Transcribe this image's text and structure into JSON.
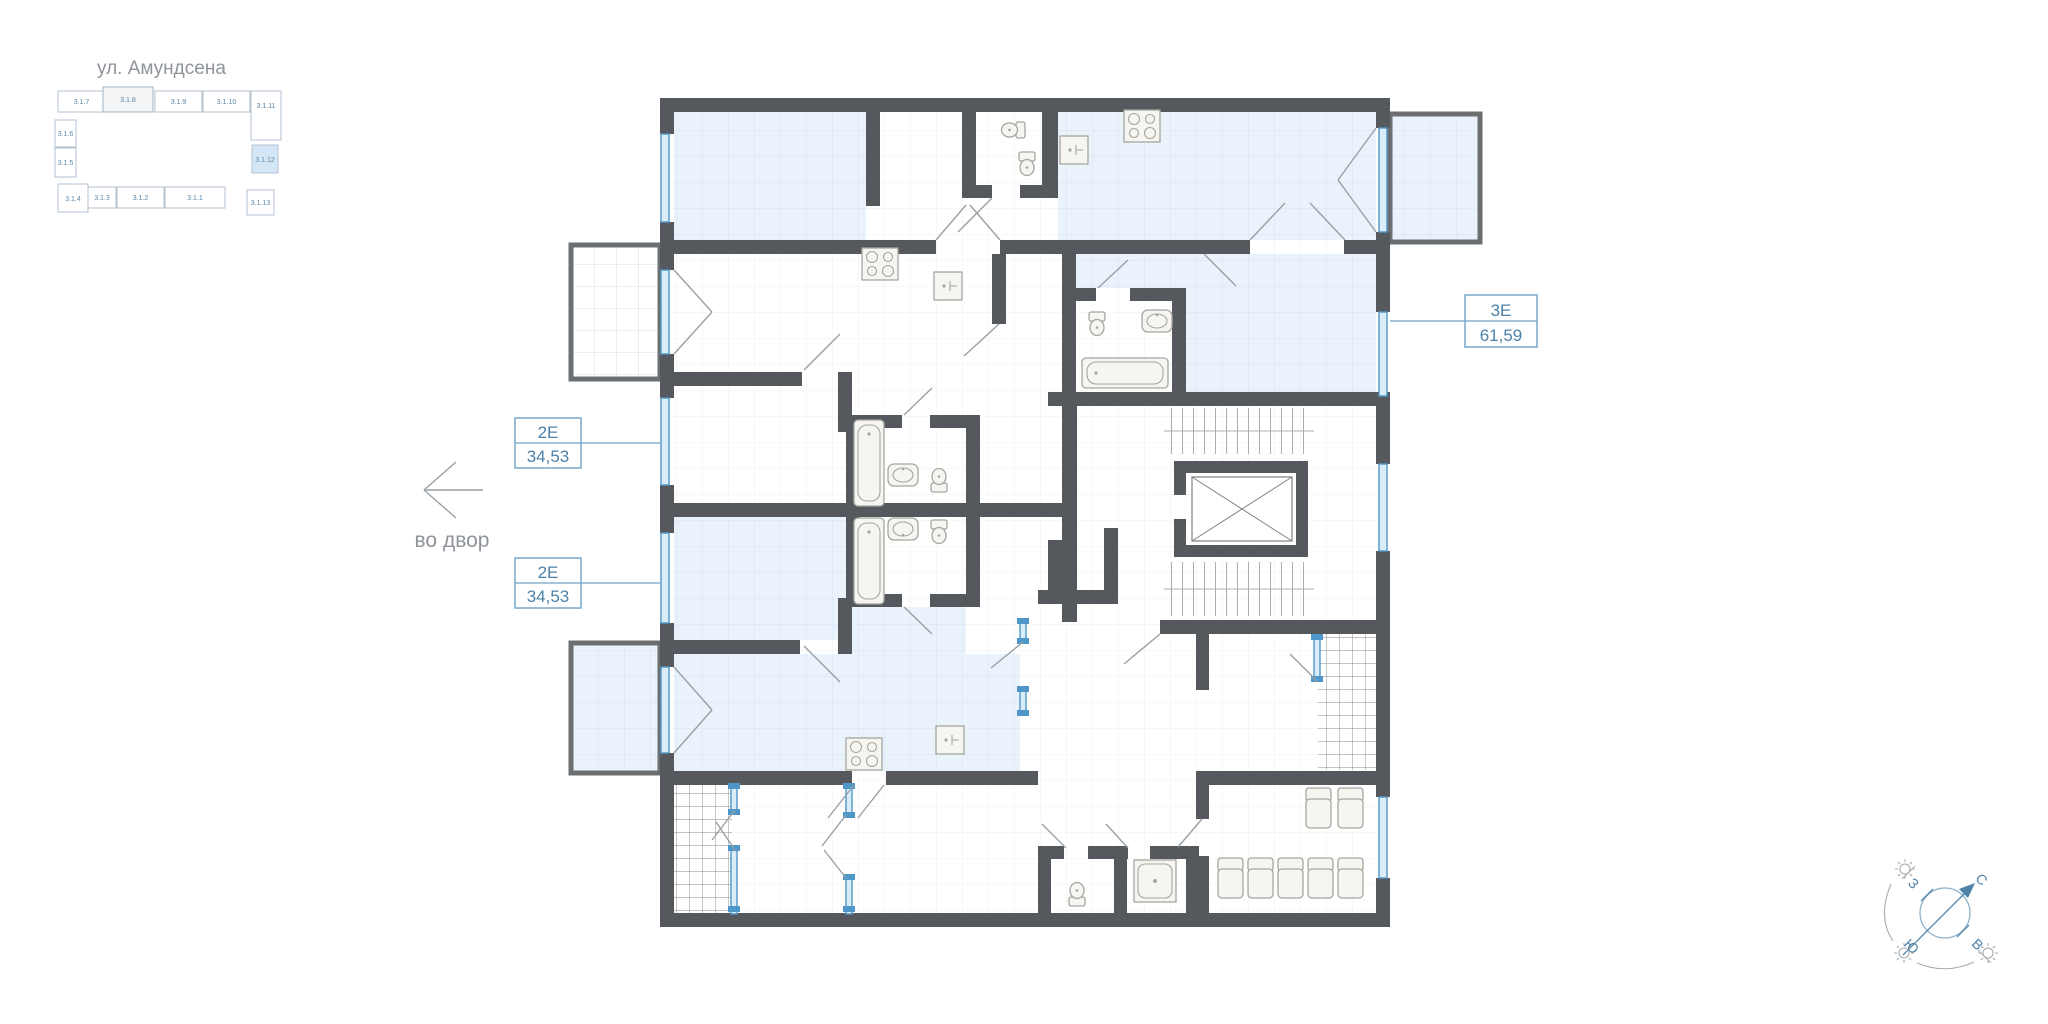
{
  "street": {
    "label": "ул. Амундсена"
  },
  "minimap": {
    "units": [
      {
        "id": "3.1.7"
      },
      {
        "id": "3.1.8"
      },
      {
        "id": "3.1.9"
      },
      {
        "id": "3.1.10"
      },
      {
        "id": "3.1.11"
      },
      {
        "id": "3.1.6"
      },
      {
        "id": "3.1.5"
      },
      {
        "id": "3.1.4"
      },
      {
        "id": "3.1.3"
      },
      {
        "id": "3.1.2"
      },
      {
        "id": "3.1.1"
      },
      {
        "id": "3.1.12"
      },
      {
        "id": "3.1.13"
      }
    ],
    "highlighted_unit": "3.1.12",
    "current_section_unit": "3.1.8"
  },
  "callouts": [
    {
      "type": "2Е",
      "area": "34,53"
    },
    {
      "type": "2Е",
      "area": "34,53"
    },
    {
      "type": "3Е",
      "area": "61,59"
    }
  ],
  "courtyard": {
    "label": "во двор"
  },
  "compass": {
    "north": "С",
    "south": "Ю",
    "west": "З",
    "east": "В"
  },
  "colors": {
    "wall": "#55585c",
    "room_fill": "#eaf2fb",
    "accent": "#4e82a8",
    "highlight": "#d4e7f7",
    "glazing": "#4f97c8"
  }
}
